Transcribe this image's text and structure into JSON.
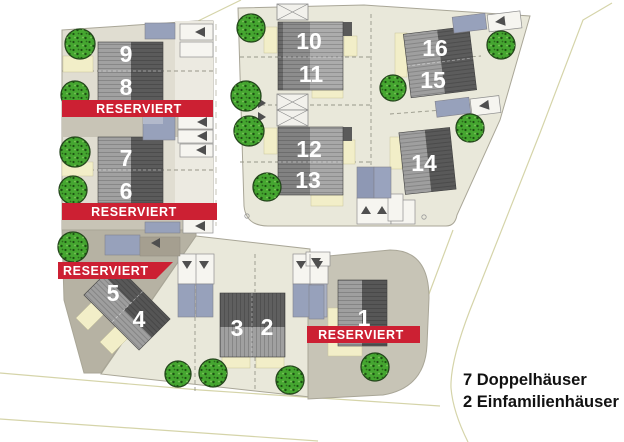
{
  "legend": {
    "line1": "7 Doppelhäuser",
    "line2": "2 Einfamilienhäuser"
  },
  "labels": {
    "reserved": "RESERVIERT"
  },
  "plot_labels": {
    "p1": "1",
    "p2": "2",
    "p3": "3",
    "p4": "4",
    "p5": "5",
    "p6": "6",
    "p7": "7",
    "p8": "8",
    "p9": "9",
    "p10": "10",
    "p11": "11",
    "p12": "12",
    "p13": "13",
    "p14": "14",
    "p15": "15",
    "p16": "16"
  },
  "icons": {
    "tree": "speckled-green-circle",
    "entry_arrow": "dark-triangle",
    "carport": "crossed-box"
  },
  "colors": {
    "banner_red": "#cc2033",
    "tree_green": "#45a630",
    "roof_dark": "#5b5b5b",
    "roof_light": "#a1a1a1",
    "garage_blue": "#97a1bb",
    "parcel_light": "#e9e8da",
    "parcel_taupe": "#b6b2a3",
    "cream": "#f2eec8",
    "road_line": "#d5d4a9"
  }
}
